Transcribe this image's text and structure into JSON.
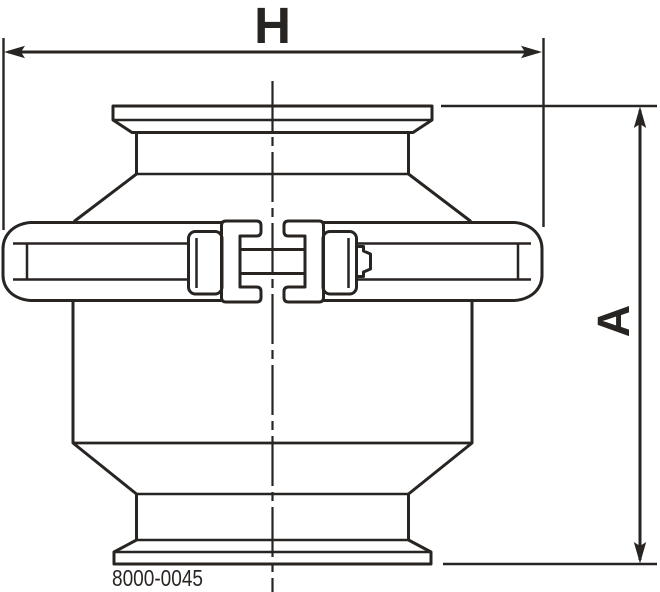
{
  "drawing": {
    "dimension_width_label": "H",
    "dimension_height_label": "A",
    "part_number": "8000-0045",
    "colors": {
      "line": "#282422",
      "background": "#ffffff"
    }
  }
}
